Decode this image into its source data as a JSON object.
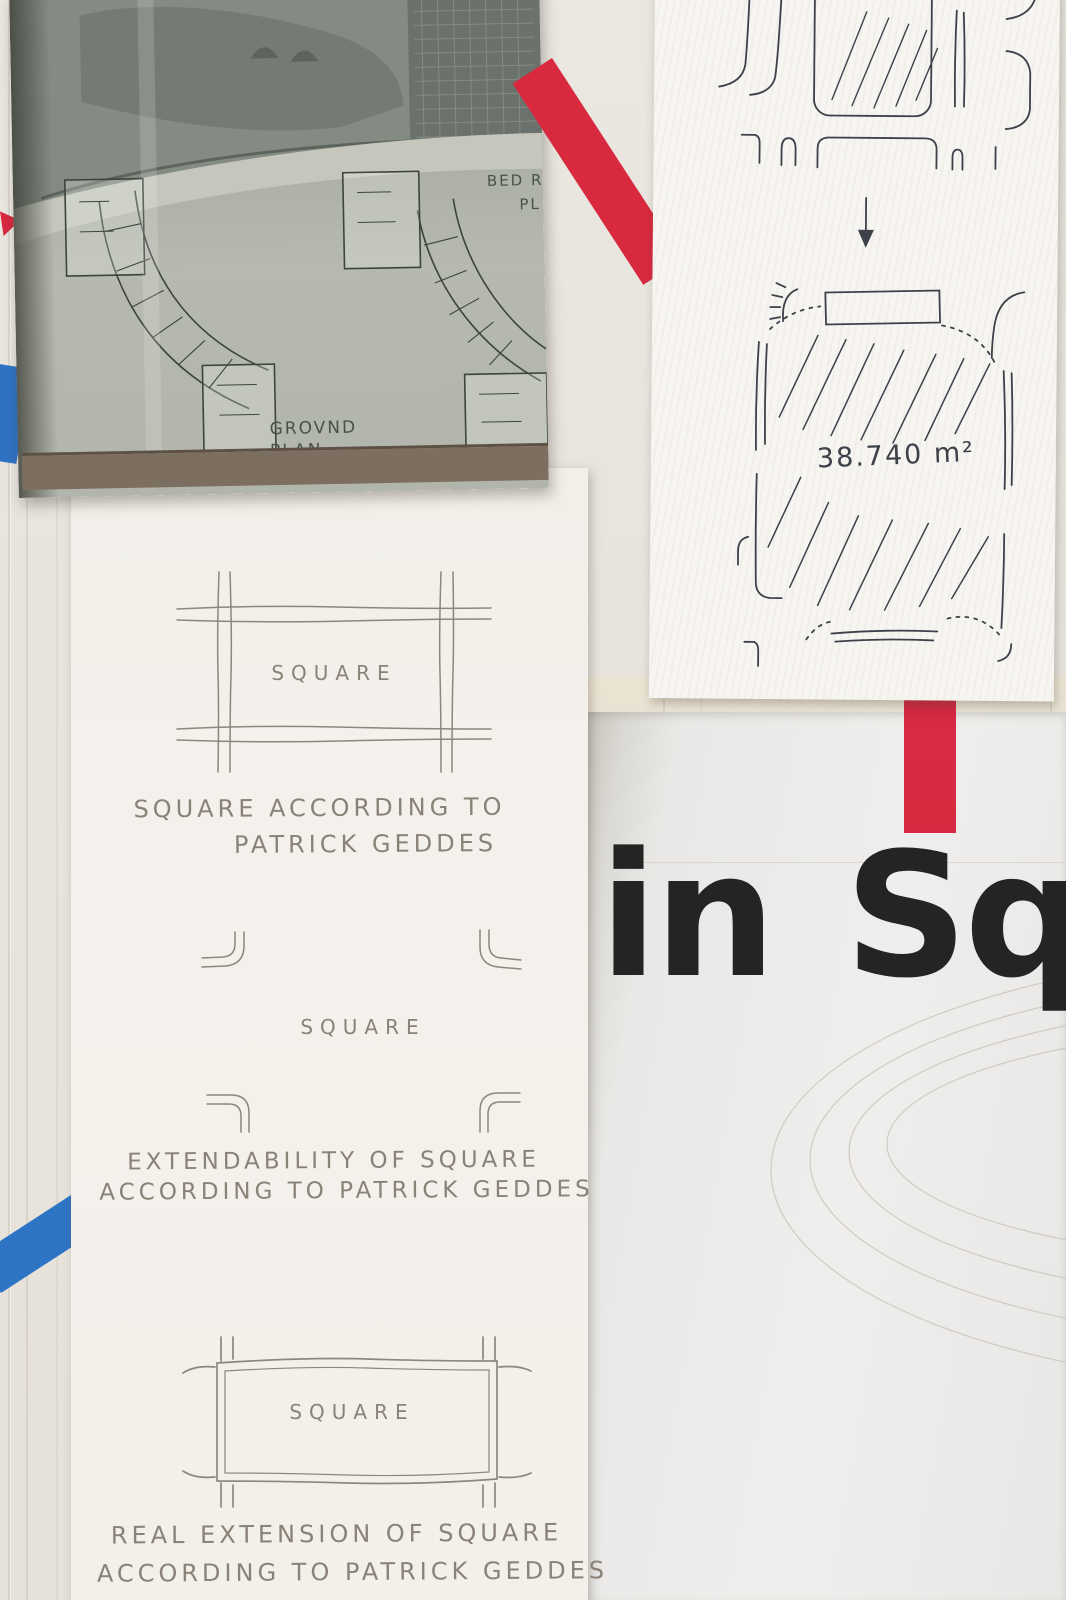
{
  "colors": {
    "wall": "#e8e4dd",
    "paper": "#f4f1ec",
    "poster_bg": "#e9e8e6",
    "red_tape": "#d8293f",
    "blue_tape": "#2f72c3",
    "ink": "#3d414a",
    "pencil": "#8a8177",
    "poster_text": "#242424",
    "book_print": "#aeb2a8"
  },
  "book": {
    "ground_plan_label_line1": "GROVND",
    "ground_plan_label_line2": "PLAN",
    "bedroom_plan_label_line1": "BED ROO",
    "bedroom_plan_label_line2": "PL"
  },
  "sketch_sheet": {
    "top_area_label_partial": "25.910 m²",
    "plaza_area_label": "38.740 m²"
  },
  "geddes_sheet": {
    "diagram1": {
      "plaza_label": "SQUARE",
      "caption_line1": "SQUARE ACCORDING TO",
      "caption_line2": "PATRICK GEDDES"
    },
    "diagram2": {
      "plaza_label": "SQUARE",
      "caption_line1": "EXTENDABILITY OF SQUARE",
      "caption_line2": "ACCORDING TO PATRICK GEDDES"
    },
    "diagram3": {
      "plaza_label": "SQUARE",
      "caption_line1": "REAL EXTENSION OF SQUARE",
      "caption_line2": "ACCORDING TO PATRICK GEDDES"
    }
  },
  "poster": {
    "headline_partial": "in Squa"
  }
}
